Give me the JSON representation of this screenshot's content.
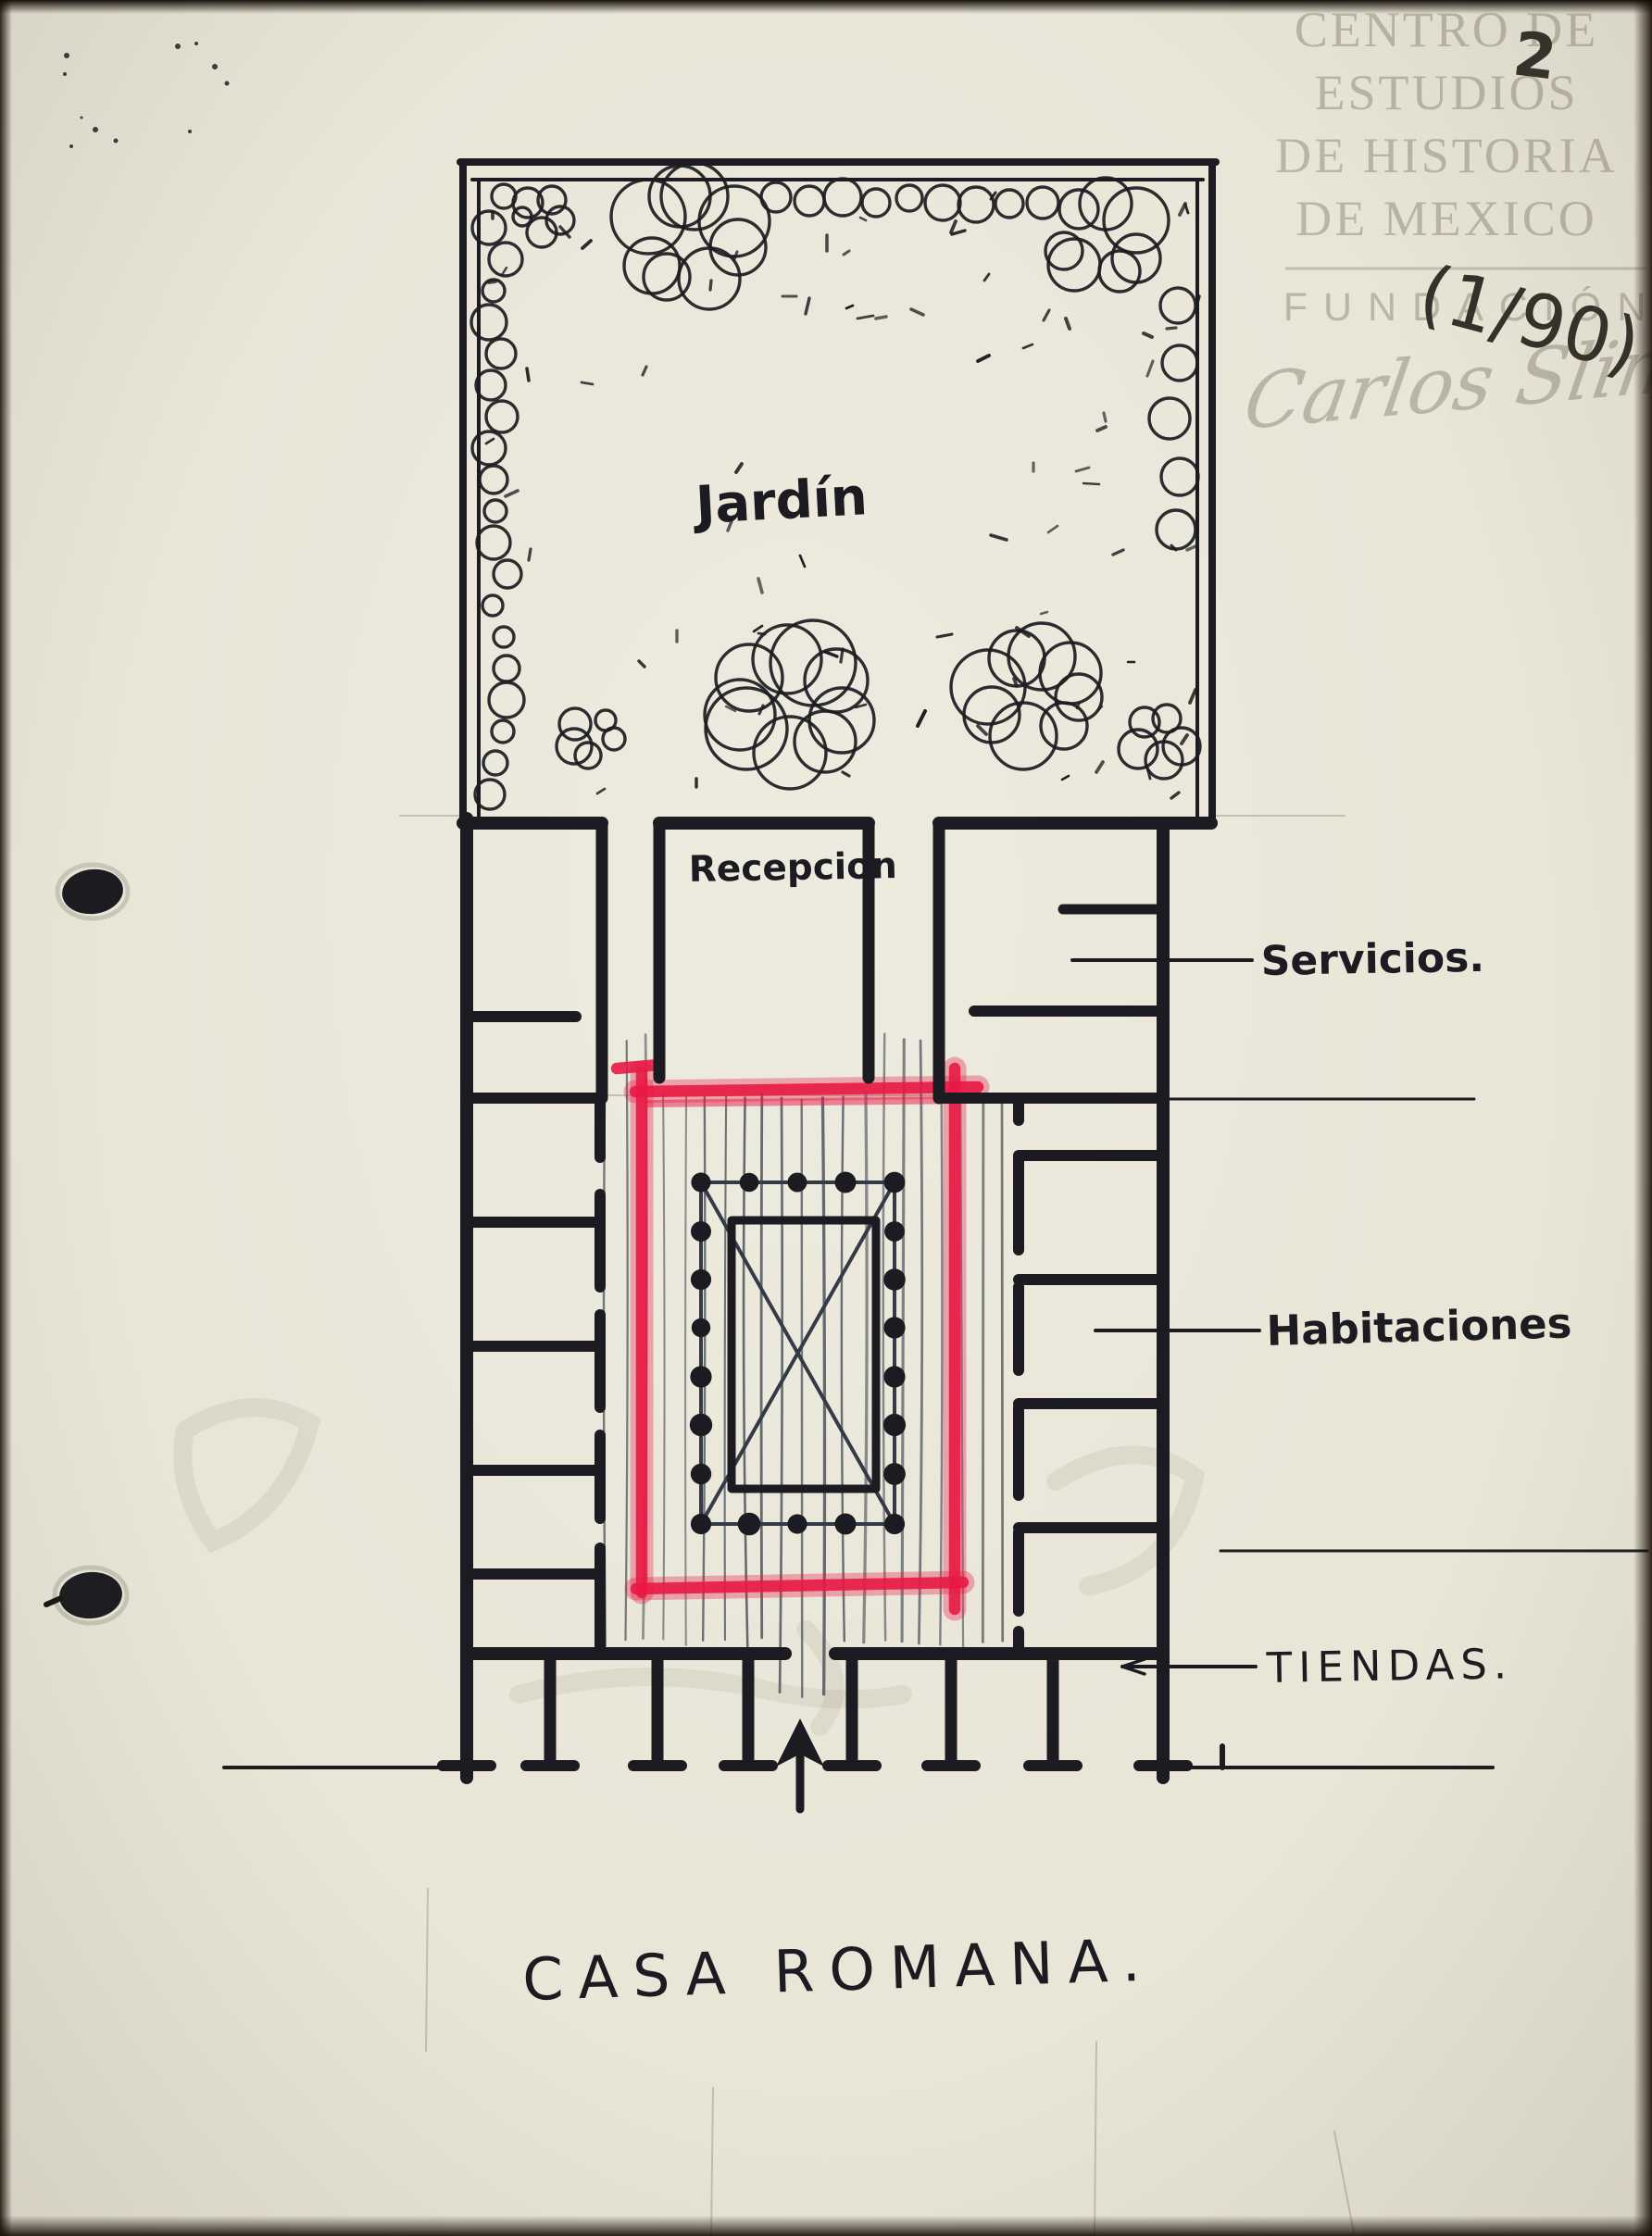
{
  "watermark": {
    "lines": [
      "CENTRO DE",
      "ESTUDIOS",
      "DE HISTORIA",
      "DE MEXICO"
    ],
    "foundation": "FUNDACIÓN",
    "signature": "Carlos Slim"
  },
  "page_marks": {
    "number": "2",
    "fraction": "(1/90)"
  },
  "plan": {
    "title": "CASA ROMANA.",
    "labels": {
      "garden": "Jardín",
      "reception": "Recepcion",
      "services": "Servicios.",
      "rooms": "Habitaciones",
      "shops": "TIENDAS."
    }
  },
  "colors": {
    "paper": "#e9e6d8",
    "ink": "#1b1b21",
    "red": "#e81a45",
    "wmk": "#b8b4a4",
    "hatch": "#4e565e",
    "pencil": "#a59f8b"
  }
}
